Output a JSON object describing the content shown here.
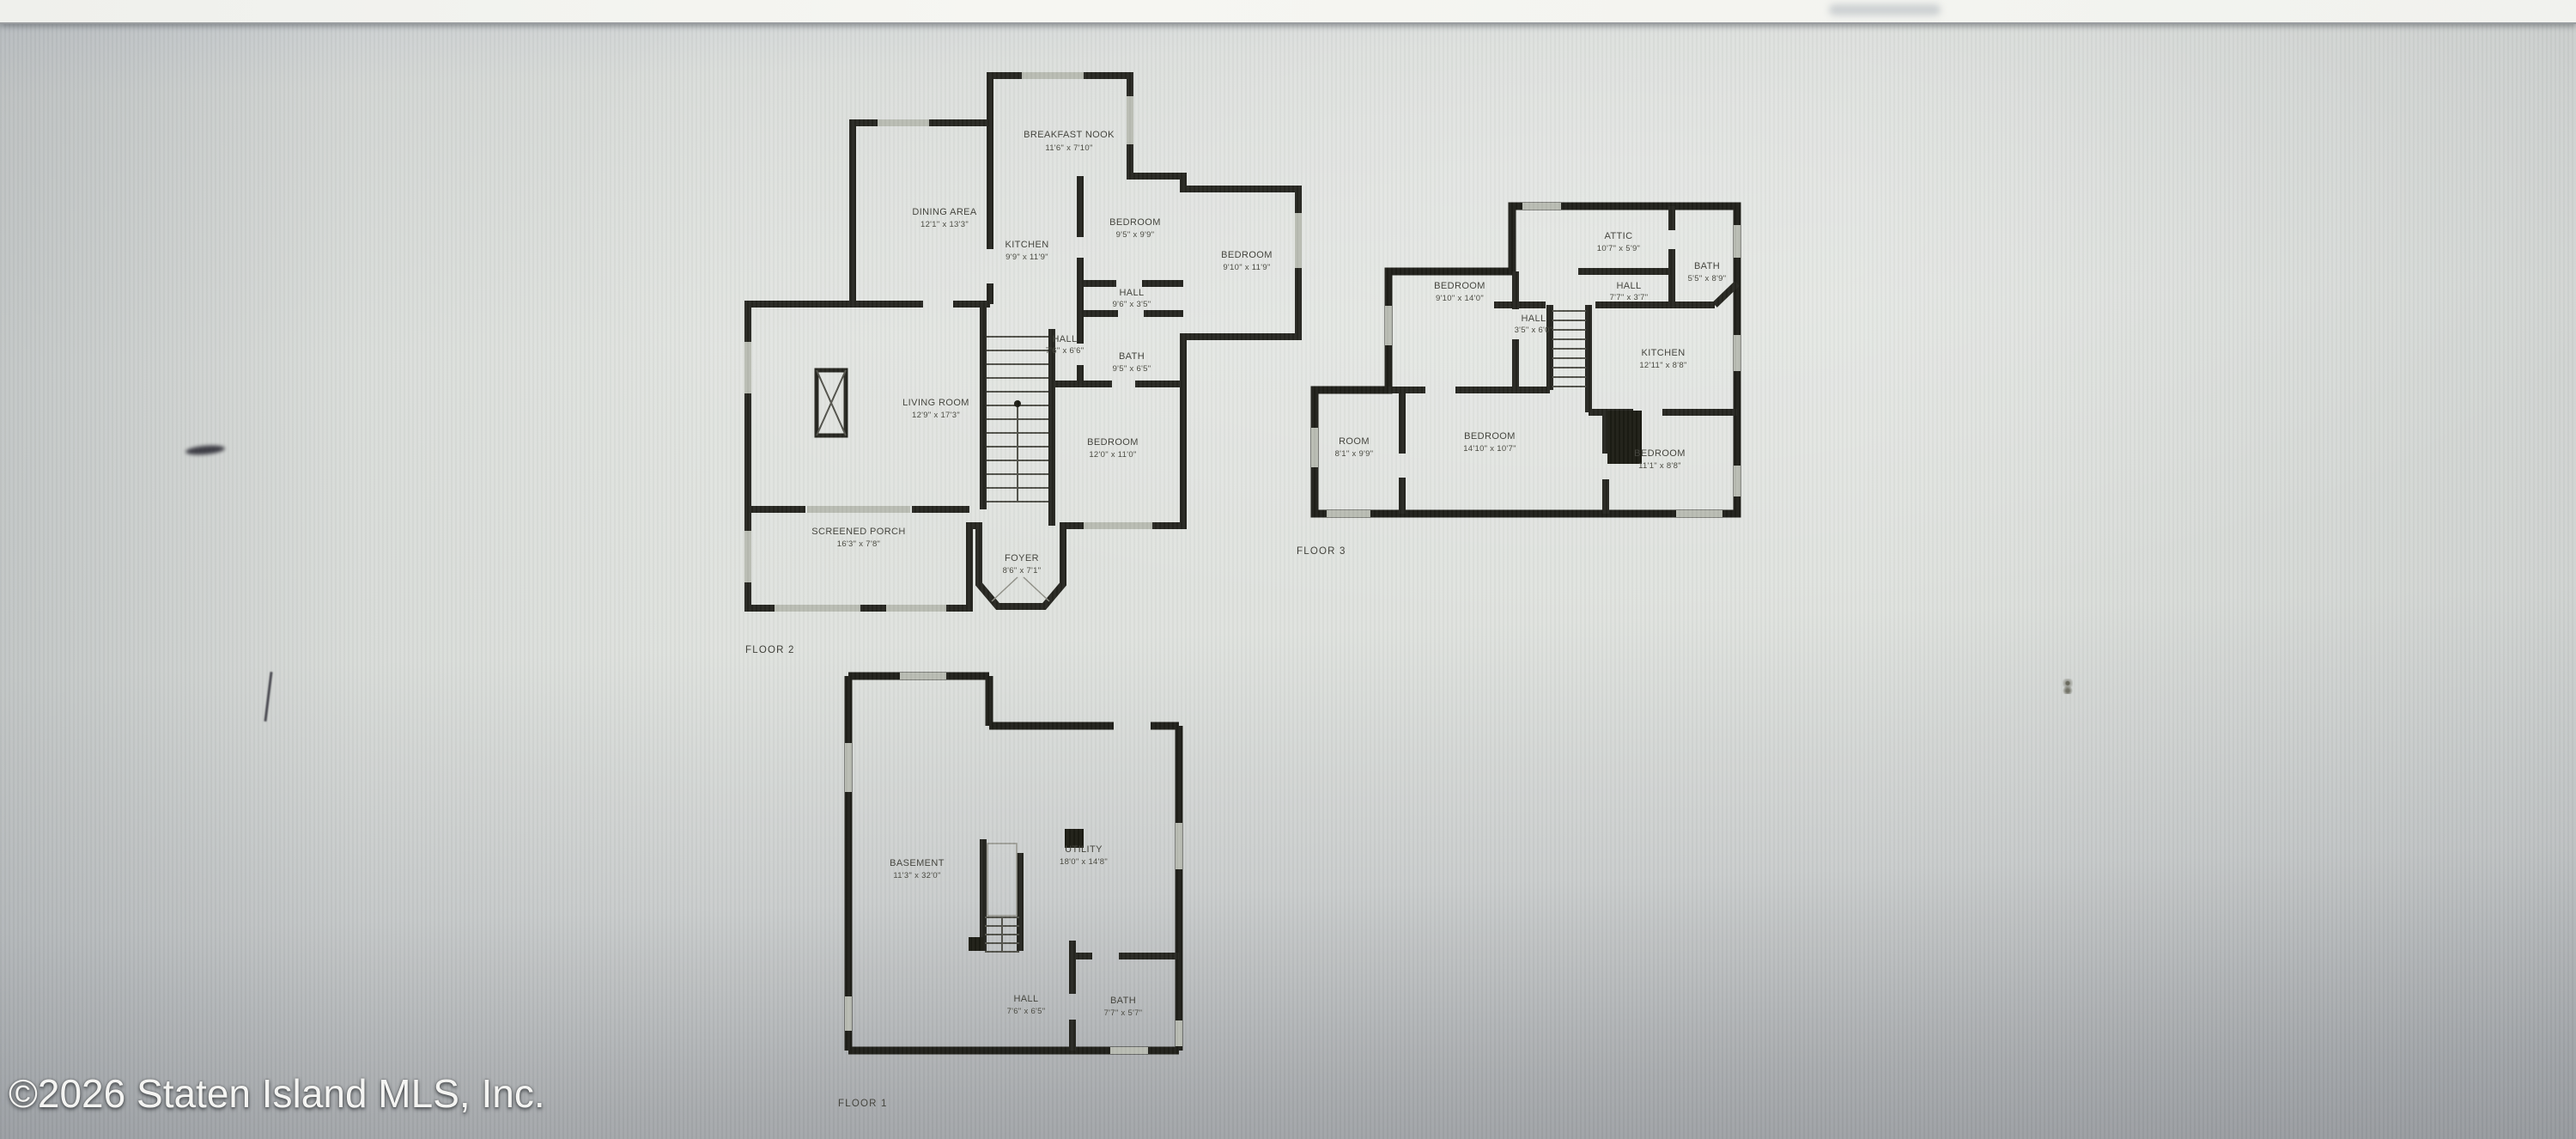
{
  "page": {
    "copyright": "©2026 Staten Island MLS, Inc."
  },
  "floors": [
    {
      "caption": "FLOOR 2",
      "rooms": [
        {
          "name": "BREAKFAST NOOK",
          "dims": "11'6\" x 7'10\""
        },
        {
          "name": "DINING AREA",
          "dims": "12'1\" x 13'3\""
        },
        {
          "name": "KITCHEN",
          "dims": "9'9\" x 11'9\""
        },
        {
          "name": "BEDROOM",
          "dims": "9'5\" x 9'9\""
        },
        {
          "name": "BEDROOM",
          "dims": "9'10\" x 11'9\""
        },
        {
          "name": "HALL",
          "dims": "9'6\" x 3'5\""
        },
        {
          "name": "HALL",
          "dims": "7'6\" x 6'6\""
        },
        {
          "name": "BATH",
          "dims": "9'5\" x 6'5\""
        },
        {
          "name": "LIVING ROOM",
          "dims": "12'9\" x 17'3\""
        },
        {
          "name": "BEDROOM",
          "dims": "12'0\" x 11'0\""
        },
        {
          "name": "SCREENED PORCH",
          "dims": "16'3\" x 7'8\""
        },
        {
          "name": "FOYER",
          "dims": "8'6\" x 7'1\""
        }
      ]
    },
    {
      "caption": "FLOOR 3",
      "rooms": [
        {
          "name": "ATTIC",
          "dims": "10'7\" x 5'9\""
        },
        {
          "name": "BATH",
          "dims": "5'5\" x 8'9\""
        },
        {
          "name": "HALL",
          "dims": "7'7\" x 3'7\""
        },
        {
          "name": "BEDROOM",
          "dims": "9'10\" x 14'0\""
        },
        {
          "name": "HALL",
          "dims": "3'5\" x 6'0\""
        },
        {
          "name": "KITCHEN",
          "dims": "12'11\" x 8'8\""
        },
        {
          "name": "ROOM",
          "dims": "8'1\" x 9'9\""
        },
        {
          "name": "BEDROOM",
          "dims": "14'10\" x 10'7\""
        },
        {
          "name": "BEDROOM",
          "dims": "11'1\" x 8'8\""
        }
      ]
    },
    {
      "caption": "FLOOR 1",
      "rooms": [
        {
          "name": "BASEMENT",
          "dims": "11'3\" x 32'0\""
        },
        {
          "name": "UTILITY",
          "dims": "18'0\" x 14'8\""
        },
        {
          "name": "HALL",
          "dims": "7'6\" x 6'5\""
        },
        {
          "name": "BATH",
          "dims": "7'7\" x 5'7\""
        }
      ]
    }
  ]
}
